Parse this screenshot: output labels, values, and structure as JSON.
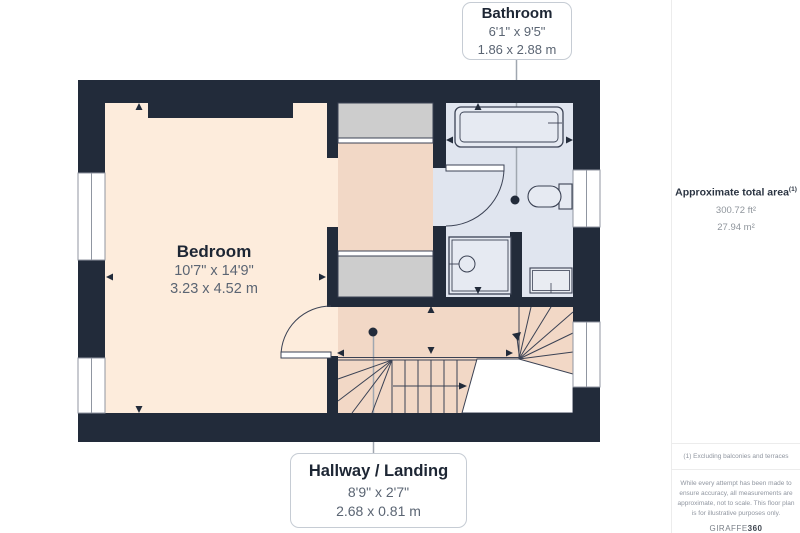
{
  "plan": {
    "labels": {
      "bathroom": {
        "title": "Bathroom",
        "imperial": "6'1\" x 9'5\"",
        "metric": "1.86 x 2.88 m"
      },
      "bedroom": {
        "title": "Bedroom",
        "imperial": "10'7\" x 14'9\"",
        "metric": "3.23 x 4.52 m"
      },
      "hallway": {
        "title": "Hallway / Landing",
        "imperial": "8'9\" x 2'7\"",
        "metric": "2.68 x 0.81 m"
      }
    },
    "colors": {
      "wall": "#222b3a",
      "bedroom_floor": "#fdecdc",
      "hallway_floor": "#f2d8c6",
      "bathroom_floor": "#e0e5ef",
      "wardrobe_fill": "#cdcdcd",
      "detail_line": "#3b4254",
      "leader_line": "#a0a7b0"
    }
  },
  "sidebar": {
    "area": {
      "title": "Approximate total area",
      "superscript": "(1)",
      "imperial": "300.72 ft²",
      "metric": "27.94 m²"
    },
    "footnote": "(1) Excluding balconies and terraces",
    "disclaimer": "While every attempt has been made to ensure accuracy, all measurements are approximate, not to scale. This floor plan is for illustrative purposes only.",
    "brand": {
      "name": "GIRAFFE",
      "suffix": "360"
    }
  }
}
